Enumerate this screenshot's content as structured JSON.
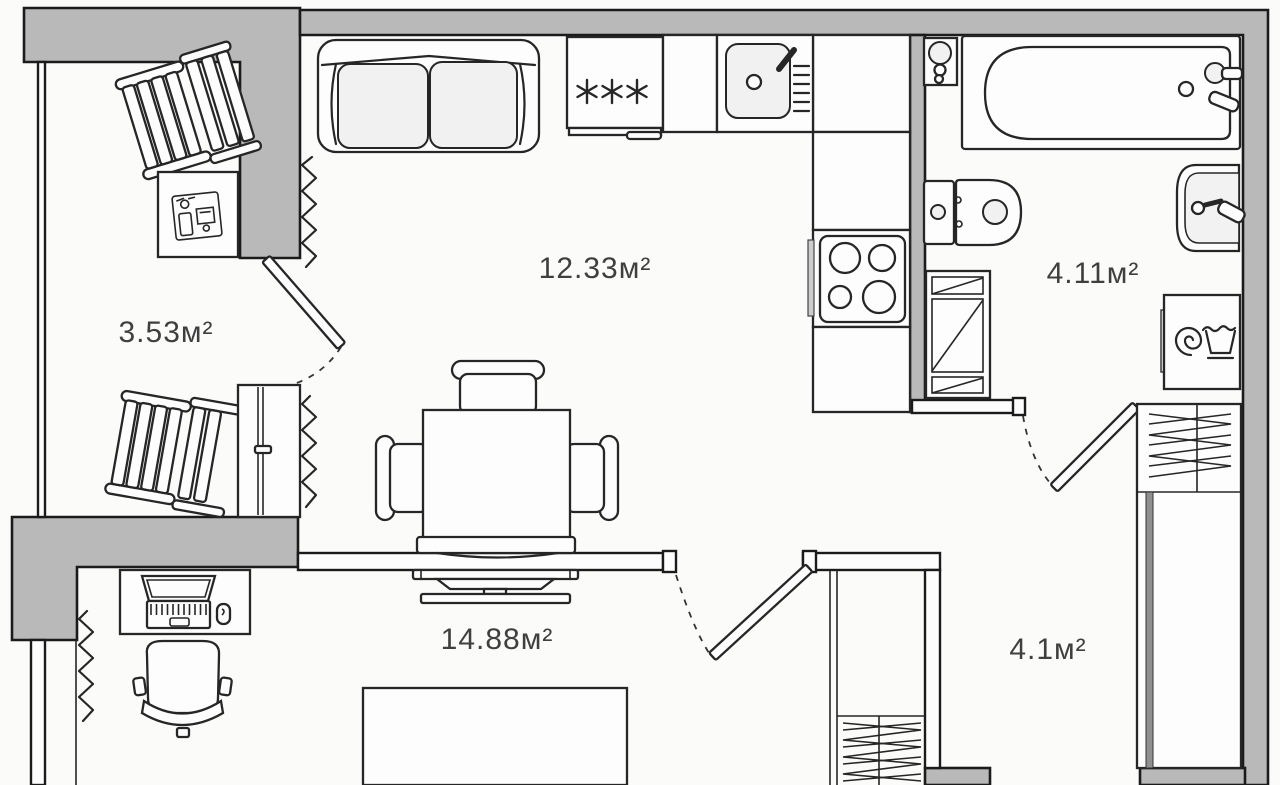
{
  "plan_type": "apartment-floor-plan",
  "rooms": [
    {
      "name": "balcony",
      "area": "3.53м²"
    },
    {
      "name": "kitchen-living",
      "area": "12.33м²"
    },
    {
      "name": "bathroom",
      "area": "4.11м²"
    },
    {
      "name": "bedroom",
      "area": "14.88м²"
    },
    {
      "name": "hallway",
      "area": "4.1м²"
    }
  ],
  "icons": {
    "fridge_freezer_symbol": "✳✳✳",
    "furniture": [
      "sofa",
      "fridge",
      "kitchen-sink",
      "stove",
      "kitchen-counter",
      "dining-table",
      "dining-chairs",
      "tv-stand",
      "wardrobe",
      "desk",
      "laptop",
      "mouse",
      "office-chair",
      "bed",
      "deck-chair",
      "balcony-table",
      "bathtub",
      "toilet",
      "washbasin",
      "washing-machine",
      "water-heater",
      "shelving-unit",
      "radiator",
      "door-swing"
    ]
  },
  "colors": {
    "wall_fill": "#b9b9b9",
    "outline": "#1c1c1c",
    "background": "#fbfbfa",
    "label_text": "#3f3f3f",
    "furniture_fill": "#fdfdfd",
    "soft_fill": "#f1f1f1"
  }
}
